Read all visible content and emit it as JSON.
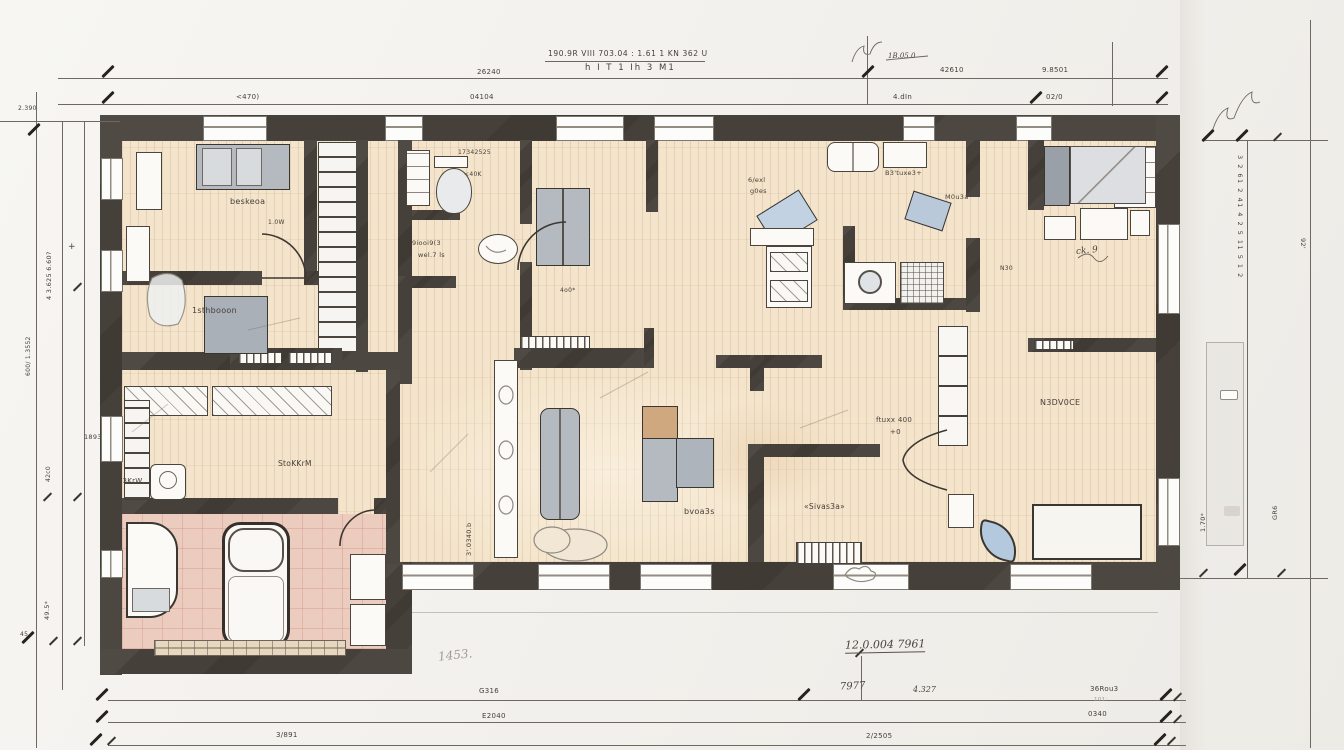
{
  "title": {
    "line1": "190.9R VIII 703.04 : 1.61 1 KN 362 U",
    "line2": "h I T 1  Ih 3 M1"
  },
  "dims": {
    "top1_mid": "26240",
    "top1_r1": "42610",
    "top1_r2": "9.8501",
    "top2_l": "<470)",
    "top2_m": "04104",
    "top2_r1": "4.dIn",
    "top2_r2": "02/0",
    "top_note": "1B.05.0",
    "left_a": "4 3.625  6.60?",
    "left_b": "600/ 1.3552",
    "left_c": "1893",
    "left_d": "42c0",
    "left_e": "49.5*",
    "left_f": "2.390",
    "left_g": "45",
    "left_plus": "+",
    "right_col": "3 2  61 2  41 4  2 5  11 5  1 2",
    "right_a": "92'",
    "right_b": "1.70*",
    "right_c": "GR6",
    "bot1_a": "G316",
    "bot1_b": "7977",
    "bot1_c": "4.327",
    "bot1_d": "36Rou3",
    "bot2_a": "E2040",
    "bot2_b": "0340",
    "bot2_c": "101:",
    "bot3_a": "3/891",
    "bot3_b": "2/2505"
  },
  "notes": {
    "main": "12.0.004 7961",
    "left": "1453."
  },
  "rooms": {
    "bedroom1": "beskeoa",
    "bedroom1_sub": "1.0W",
    "bedroom2": "1sthbooon",
    "bath_top": "17342525",
    "wc_small": "<40K",
    "shower_l1": "9iooi9(3",
    "shower_l2": "wel.7 ls",
    "hall_tiny": "4o0*",
    "kitchen_l1": "6/exl",
    "kitchen_l2": "g0es",
    "kitchen_top": "B3'tuxe3+",
    "kitchen_r": "M0u3a",
    "kitchen_n": "N30",
    "tr_note": "ck. 9",
    "room_right": "N3DV0CE",
    "store_r_l1": "ftuxx 400",
    "store_r_l2": "+0",
    "store_r2": "«Sivas3a»",
    "living": "bvoa3s",
    "store_l1": "StoKKrM",
    "store_l2": "4l0u3KrW",
    "shelf_rot": "3'.0340.b"
  },
  "colors": {
    "wall": "#46403a",
    "floor": "#f4e4cb",
    "tile": "#edccc0",
    "fixture_blue": "#b4c9dd",
    "furniture_gray": "#b5bac1",
    "line": "#6e6862"
  }
}
